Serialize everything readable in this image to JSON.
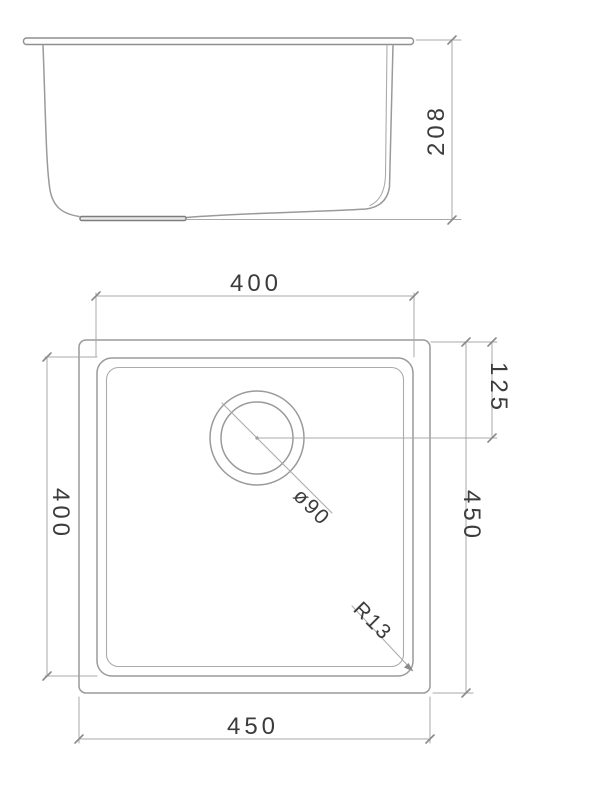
{
  "drawing": {
    "title": "sink-technical-drawing",
    "side_view": {
      "depth_dim": "208"
    },
    "top_view": {
      "bowl_width_dim": "400",
      "bowl_length_dim": "400",
      "outer_length_dim": "450",
      "outer_width_dim": "450",
      "drain_offset_dim": "125",
      "drain_diameter_dim": "ø90",
      "corner_radius_dim": "R13"
    },
    "colors": {
      "object_line": "#9a9a9a",
      "dimension_line": "#a9a9a9",
      "tick": "#8a8a8a",
      "text": "#3c3c3c",
      "background": "#ffffff",
      "drain_foot_fill": "#e9e9e9",
      "drain_foot_stroke": "#7d7d7d"
    }
  }
}
